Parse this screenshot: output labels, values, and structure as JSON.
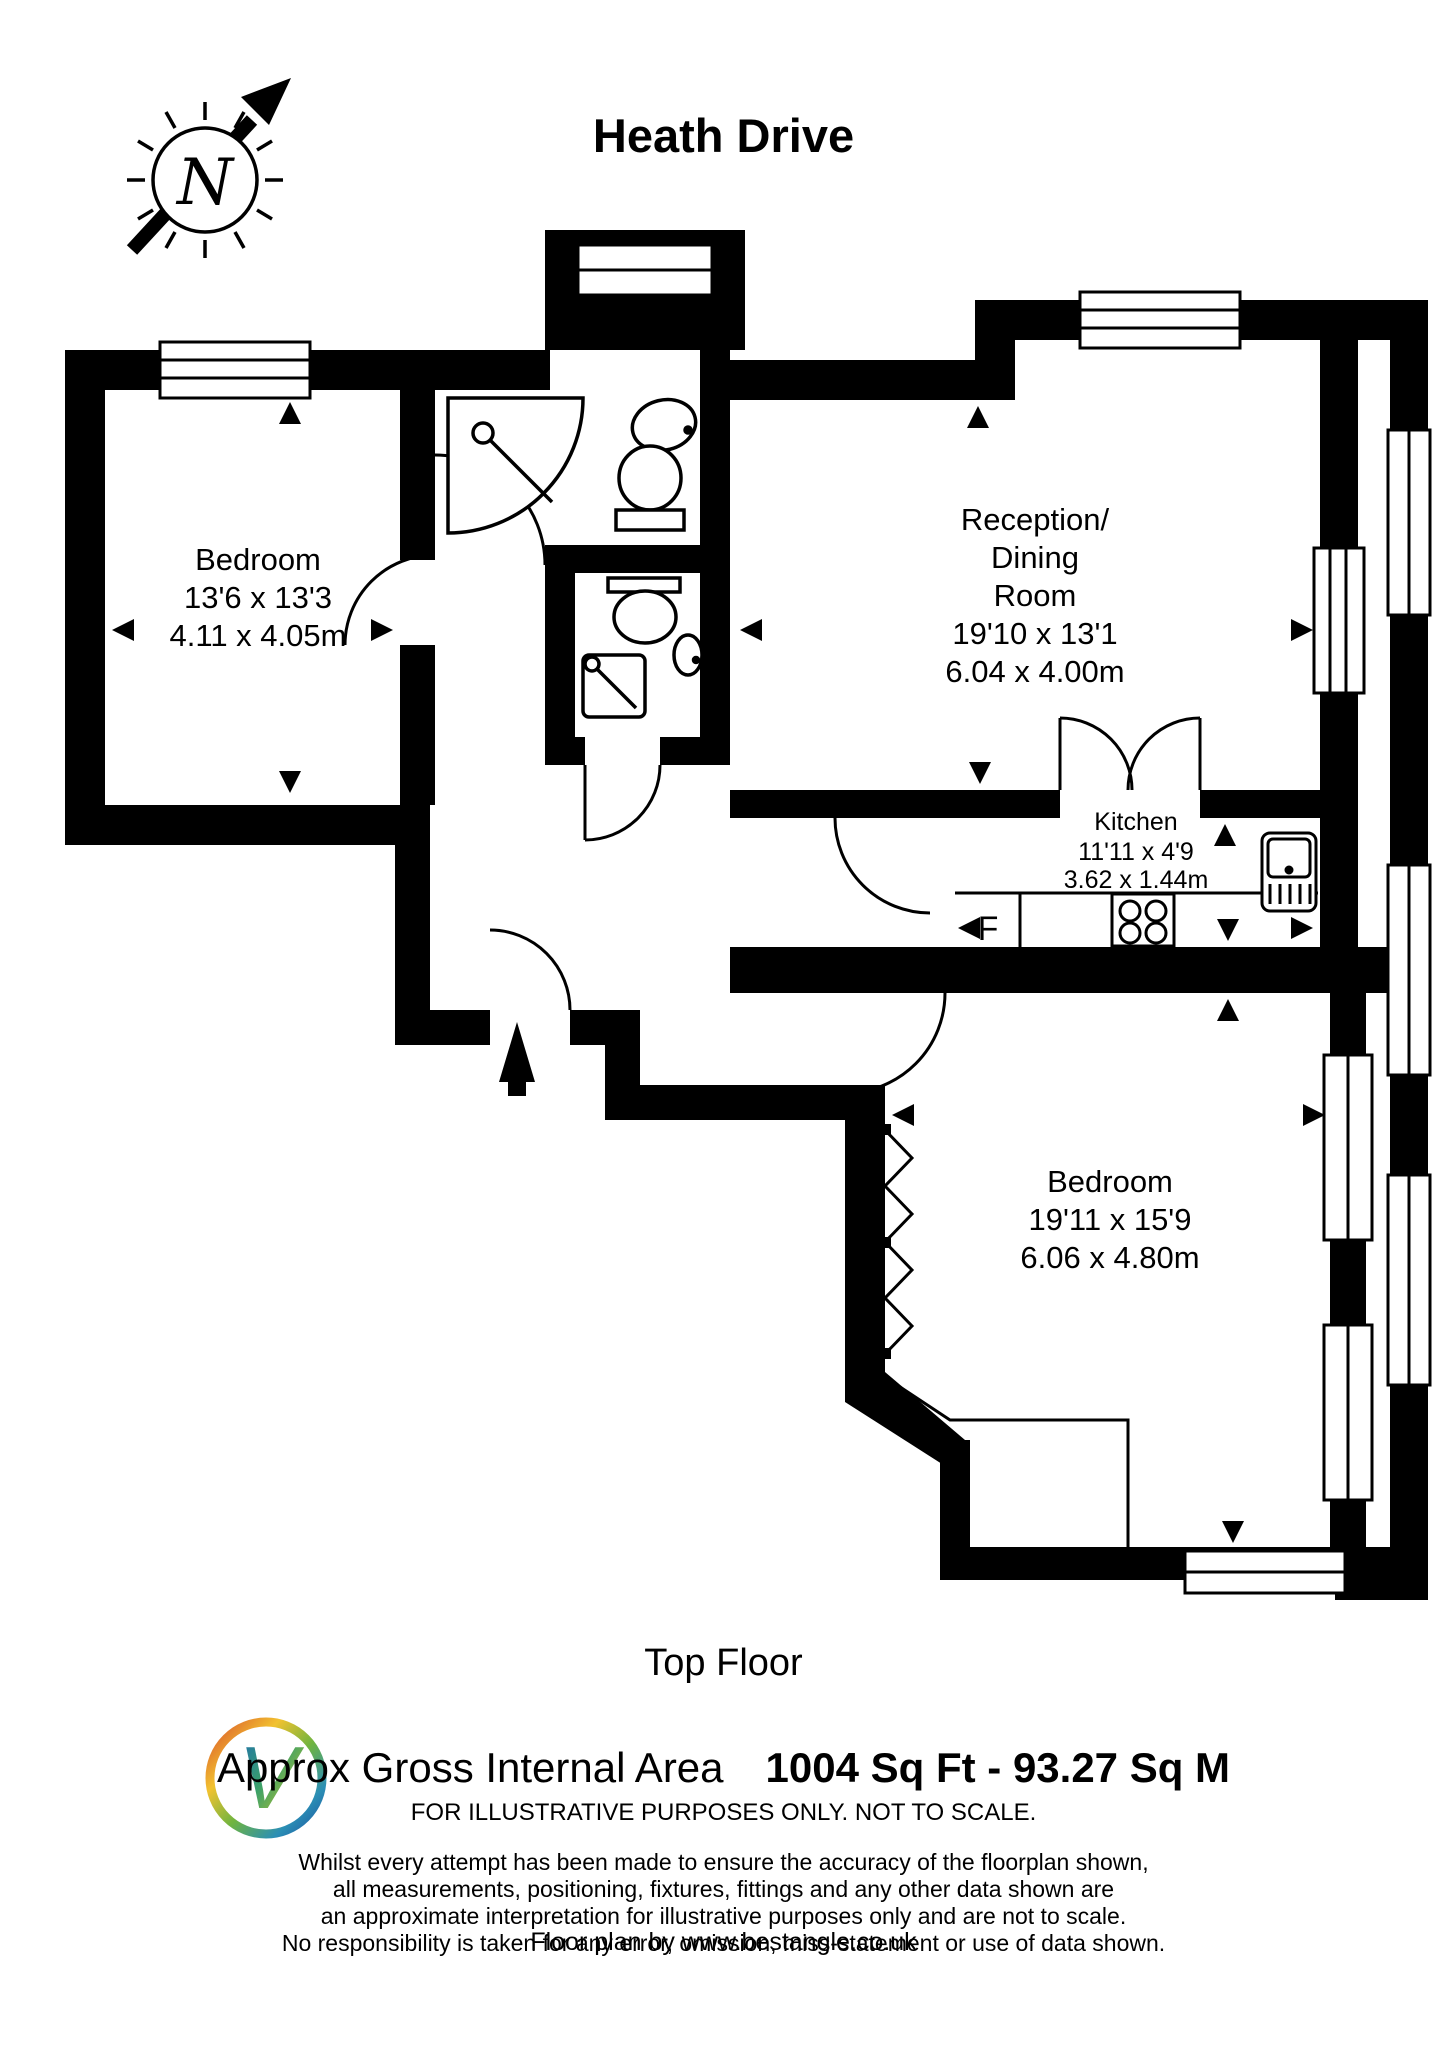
{
  "title": "Heath Drive",
  "compass": {
    "label": "N"
  },
  "rooms": {
    "bedroom1": {
      "name": "Bedroom",
      "imperial": "13'6 x 13'3",
      "metric": "4.11 x 4.05m"
    },
    "reception": {
      "line1": "Reception/",
      "line2": "Dining",
      "line3": "Room",
      "imperial": "19'10 x 13'1",
      "metric": "6.04 x 4.00m"
    },
    "kitchen": {
      "name": "Kitchen",
      "imperial": "11'11 x 4'9",
      "metric": "3.62 x 1.44m"
    },
    "bedroom2": {
      "name": "Bedroom",
      "imperial": "19'11 x 15'9",
      "metric": "6.06 x 4.80m"
    }
  },
  "labels": {
    "fridge": "F"
  },
  "floor": {
    "name": "Top Floor"
  },
  "area": {
    "label": "Approx Gross Internal Area",
    "value": "1004 Sq Ft  -  93.27 Sq M"
  },
  "logo": {
    "letter": "V"
  },
  "disclaimer": {
    "line1": "FOR ILLUSTRATIVE PURPOSES ONLY. NOT TO SCALE.",
    "line2": "Whilst every attempt has been made to ensure the accuracy of the floorplan shown,",
    "line3": "all measurements, positioning, fixtures, fittings and any other data shown are",
    "line4": "an approximate interpretation for illustrative purposes only and are not to scale.",
    "line5": "No responsibility is taken for any error, omission, miss-statement or use of data shown.",
    "credit": "Floor plan by www.bestangle.co.uk"
  },
  "colors": {
    "wall": "#000000",
    "background": "#ffffff"
  }
}
